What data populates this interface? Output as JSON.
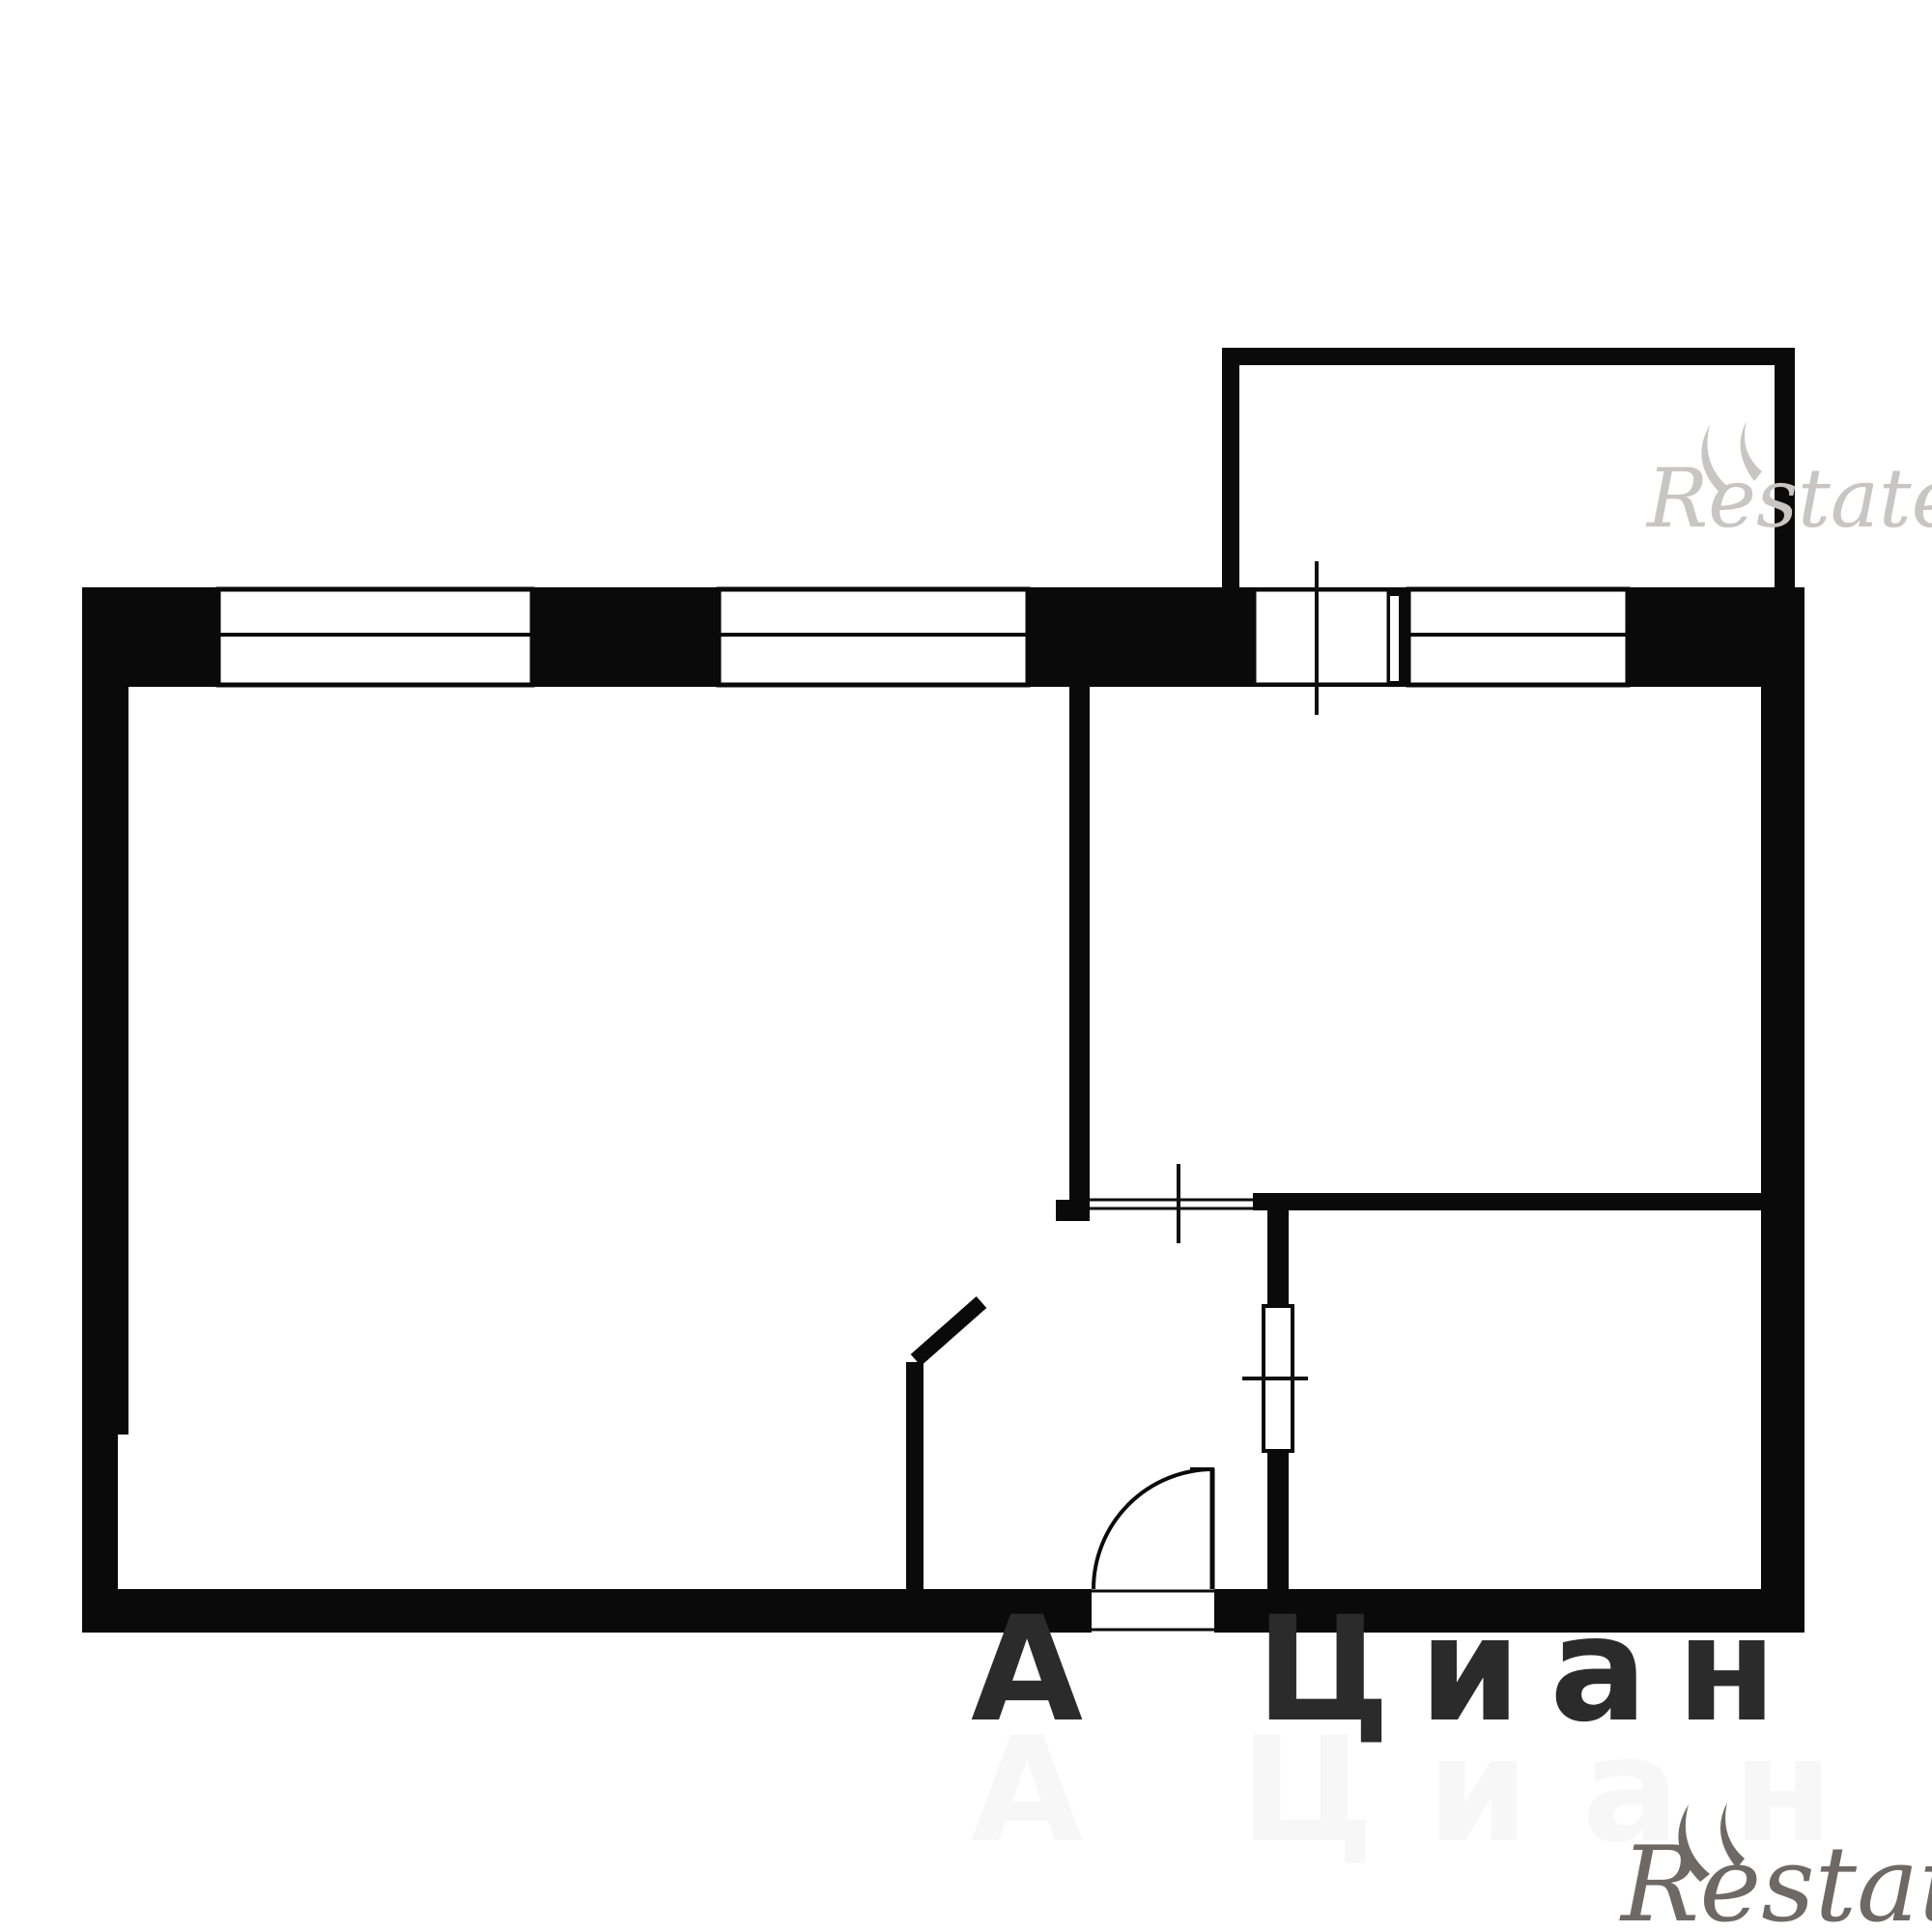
{
  "colors": {
    "background": "#ffffff",
    "wall": "#0a0a0a",
    "opening_fill": "#ffffff",
    "frame_stroke": "#0a0a0a",
    "tick": "#111111",
    "cian_dark": "#2b2b2b",
    "cian_ghost": "#9a9a9a",
    "restate_top": "#c8c5c2",
    "restate_bottom": "#57504b"
  },
  "watermarks": {
    "cian_mark": "А",
    "cian_text": "Циан",
    "cian_ghost_text": "А Циан",
    "restate_top_text": "Restate",
    "restate_bottom_text": "Restate"
  },
  "floorplan": {
    "type": "apartment-floor-plan",
    "style": "black-and-white line drawing",
    "features": [
      "rectangular outer walls",
      "balcony at top right",
      "window top-left",
      "window top-center",
      "window top-right",
      "balcony door with tick mark",
      "interior partition between left room and top-right room",
      "door opening with sill and tick into top-right room",
      "bottom-right room with door element and tick on left wall",
      "short stub wall with diagonal open door leaf",
      "entrance opening in bottom wall with quarter-circle door swing arc"
    ],
    "window_count": 3,
    "tick_mark_count": 3,
    "door_arc_count": 1
  }
}
